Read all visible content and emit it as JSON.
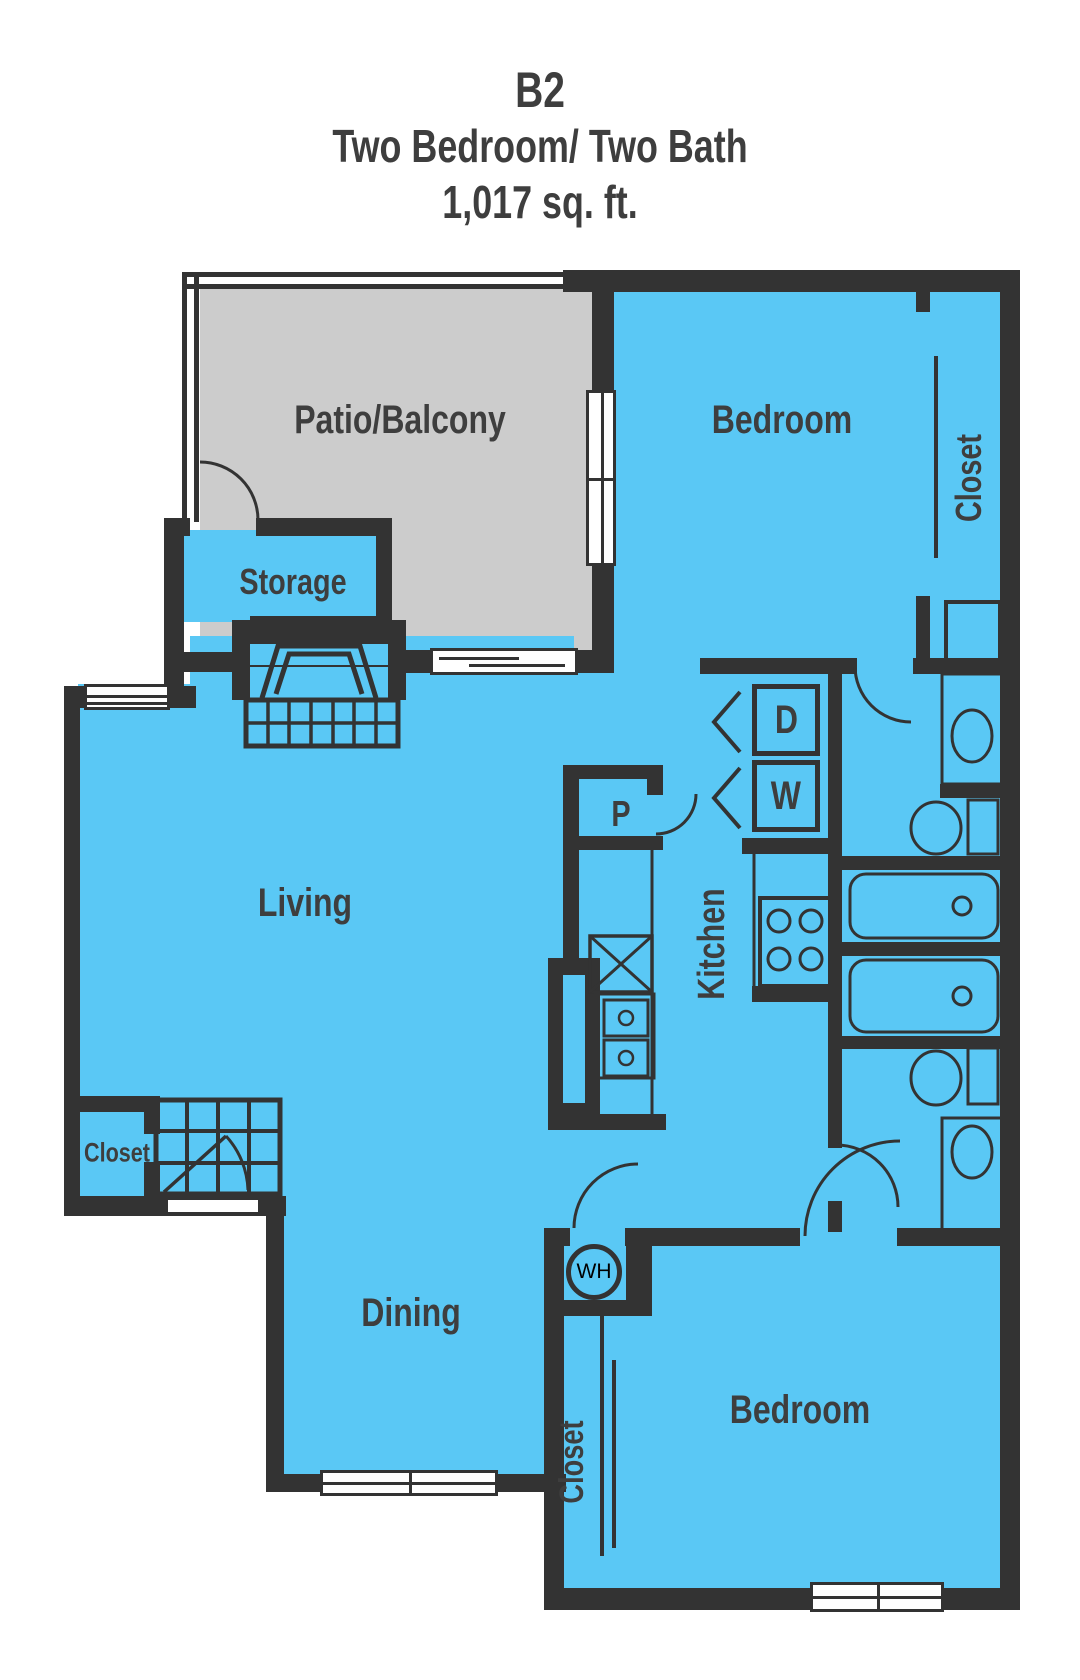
{
  "title": {
    "code": "B2",
    "type": "Two Bedroom/ Two Bath",
    "area": "1,017 sq. ft."
  },
  "rooms": {
    "patio": "Patio/Balcony",
    "storage": "Storage",
    "bedroom_top": "Bedroom",
    "closet_bedroom_top": "Closet",
    "living": "Living",
    "kitchen": "Kitchen",
    "dining": "Dining",
    "entry_closet": "Closet",
    "closet_bedroom_bottom": "Closet",
    "bedroom_bottom": "Bedroom"
  },
  "appliances": {
    "pantry": "P",
    "dryer": "D",
    "washer": "W",
    "water_heater": "WH"
  },
  "colors": {
    "floor": "#5AC8F5",
    "patio": "#CCCCCC",
    "walls": "#333333",
    "text": "#3E3E3E",
    "background": "#FFFFFF"
  }
}
